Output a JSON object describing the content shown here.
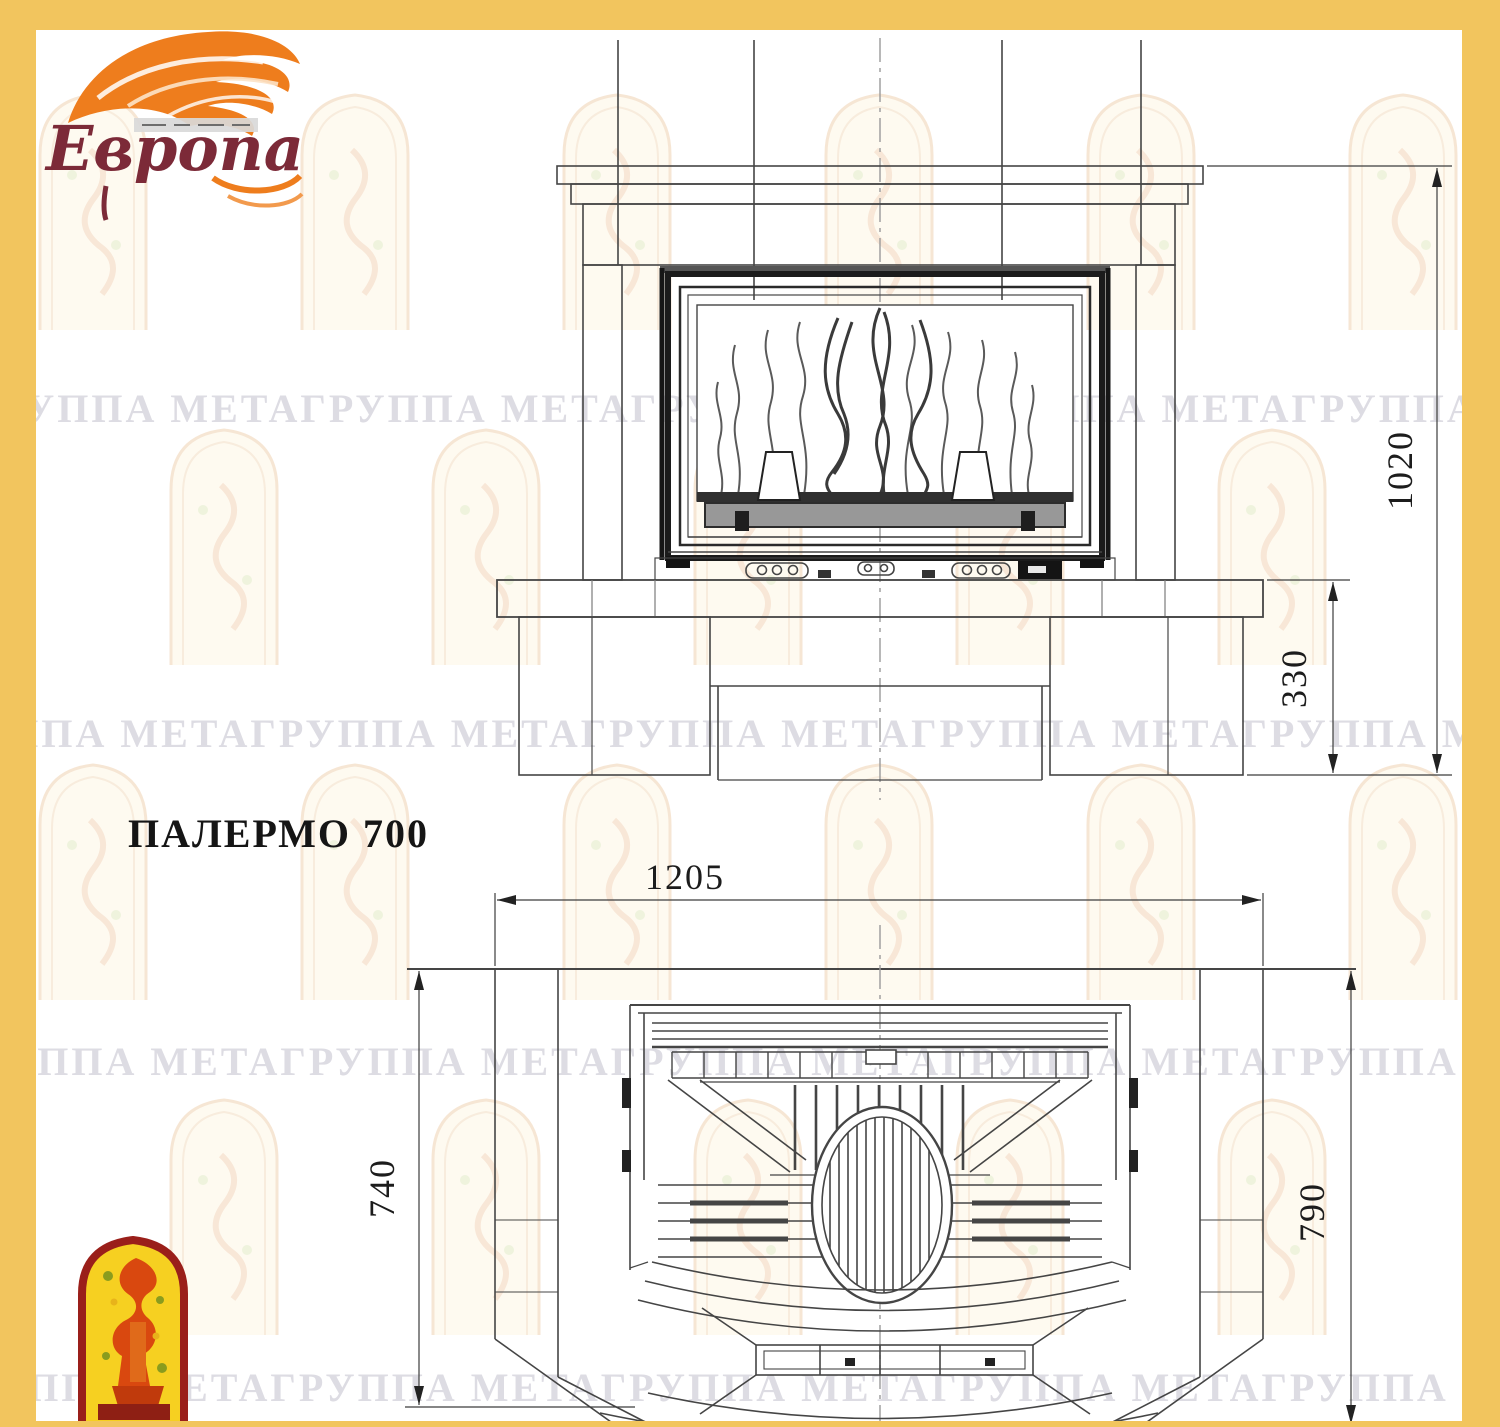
{
  "title": "ПАЛЕРМО 700",
  "brand": {
    "name": "Европа"
  },
  "watermark": {
    "text_line": "ГРУППА МЕТАГРУППА МЕТАГРУППА МЕТАГРУППА МЕТАГРУППА МЕТА"
  },
  "drawing": {
    "type": "fireplace technical drawing, front elevation and top plan",
    "model": "ПАЛЕРМО 700",
    "units": "mm",
    "dim_labels": {
      "h1020": "1020",
      "h330": "330",
      "w1205": "1205",
      "d740": "740",
      "d790": "790"
    },
    "dimensions_mm": {
      "front_view": {
        "overall_height": 1020,
        "base_height": 330
      },
      "plan_view": {
        "overall_width": 1205,
        "side_depth": 740,
        "overall_depth": 790
      }
    }
  },
  "colors": {
    "page_border": "#f2c55e",
    "line": "#454545",
    "heavy_line": "#1b1b1b",
    "sill_grey": "#989898",
    "brand_flame": "#ee7d1d",
    "brand_text": "#7c2a38",
    "badge_fill": "#f6d021",
    "badge_border": "#9a1f1a",
    "badge_figure": "#d9480f",
    "watermark_text": "#dcdbe2"
  }
}
